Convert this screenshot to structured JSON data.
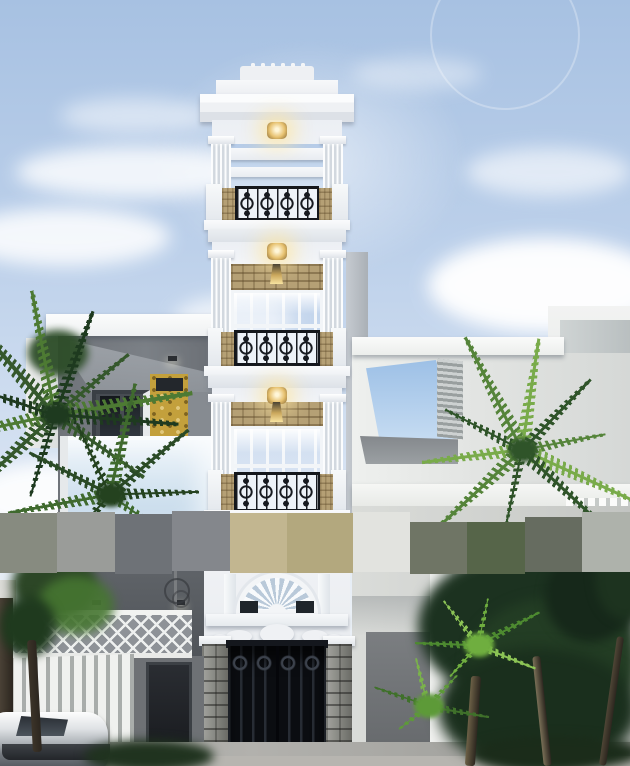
{
  "scene": {
    "type": "architectural-exterior-render",
    "width": 630,
    "height": 766,
    "description": "3D render of a narrow multi-storey neoclassical white townhouse with gold lamps and ornate black wrought-iron balconies, flanked by a dark modern house with glass balcony on the left and white modern volumes on the right, palms and leafy trees at street level, white slat fence, black entry gate on stone-clad columns, a parked car lower-left, blue sky with clouds, and a pixelated censor strip across the middle of the image"
  },
  "palette": {
    "sky_top": "#a7c1e2",
    "sky_mid": "#bcd0ea",
    "sky_low": "#d3e0f1",
    "sky_horizon": "#e9eff6",
    "white_wall": "#f2f3f5",
    "wall_shadow": "#d7dbe1",
    "iron_black": "#14171c",
    "lamp_gold": "#e7c271",
    "lamp_glow": "#fff3c8",
    "stone_tan": "#b5a075",
    "stone_grey": "#85867f",
    "left_house_wall": "#70747a",
    "accent_yellow": "#c3a03c",
    "balcony_glass": "#d9e7f2",
    "right_house_wall": "#e2e4e2",
    "ground_grey": "#a4a4a0",
    "gate_black": "#0b0d11",
    "tree_dark": "#1c3220",
    "tree_mid": "#35582c",
    "tree_bright": "#72a844"
  },
  "censor_band": {
    "default_y": 513,
    "default_h": 60,
    "blocks": [
      {
        "x": 0,
        "w": 57,
        "c": "#878b80"
      },
      {
        "x": 57,
        "w": 58,
        "c": "#9a9c99",
        "y": 512
      },
      {
        "x": 115,
        "w": 57,
        "c": "#6e7277",
        "y": 514
      },
      {
        "x": 172,
        "w": 58,
        "c": "#84878c",
        "y": 511
      },
      {
        "x": 230,
        "w": 57,
        "c": "#c2b690"
      },
      {
        "x": 287,
        "w": 66,
        "c": "#b3a87e"
      },
      {
        "x": 353,
        "w": 57,
        "c": "#e2e3df",
        "y": 512
      },
      {
        "x": 410,
        "w": 57,
        "c": "#6f7565",
        "y": 522,
        "h": 52
      },
      {
        "x": 467,
        "w": 58,
        "c": "#566549",
        "y": 522,
        "h": 52
      },
      {
        "x": 525,
        "w": 57,
        "c": "#666c60",
        "y": 517,
        "h": 55
      },
      {
        "x": 582,
        "w": 48,
        "c": "#aeb2ab",
        "y": 512
      }
    ]
  },
  "lamps": {
    "ceiling": [
      {
        "x": 267,
        "y": 122
      },
      {
        "x": 267,
        "y": 243
      },
      {
        "x": 267,
        "y": 387
      }
    ],
    "sconces": [
      {
        "x": 270,
        "y": 264
      },
      {
        "x": 270,
        "y": 402
      }
    ]
  },
  "trees": {
    "palms": [
      {
        "name": "left-palm-upper",
        "cx": 55,
        "cy": 415,
        "count": 11,
        "len": 118,
        "start": -245,
        "end": 40,
        "colors": [
          "#1e3a1f",
          "#35582c",
          "#4d7a33"
        ]
      },
      {
        "name": "left-palm-lower",
        "cx": 110,
        "cy": 495,
        "count": 8,
        "len": 95,
        "start": -220,
        "end": 30,
        "colors": [
          "#24421f",
          "#3f6a2e",
          "#2a4a26"
        ]
      },
      {
        "name": "right-palm",
        "cx": 522,
        "cy": 450,
        "count": 10,
        "len": 105,
        "start": -250,
        "end": 50,
        "colors": [
          "#2f5429",
          "#55843a",
          "#79ab4a"
        ]
      },
      {
        "name": "ground-fan-1",
        "cx": 478,
        "cy": 645,
        "count": 6,
        "len": 58,
        "start": -220,
        "end": 20,
        "colors": [
          "#6fae3f",
          "#4d8a30",
          "#8cc455"
        ]
      },
      {
        "name": "ground-fan-2",
        "cx": 428,
        "cy": 706,
        "count": 5,
        "len": 52,
        "start": -210,
        "end": 10,
        "colors": [
          "#5d9a38",
          "#3f702a",
          "#7ab34a"
        ]
      }
    ],
    "canopies": [
      {
        "x": 418,
        "y": 552,
        "w": 215,
        "h": 150,
        "c": "#1c3220",
        "blur": 6,
        "o": 1
      },
      {
        "x": 468,
        "y": 598,
        "w": 170,
        "h": 132,
        "c": "#233d24",
        "blur": 6,
        "o": 1
      },
      {
        "x": 545,
        "y": 550,
        "w": 90,
        "h": 92,
        "c": "#16281a",
        "blur": 5,
        "o": 1
      },
      {
        "x": 438,
        "y": 648,
        "w": 200,
        "h": 122,
        "c": "#1a2f1d",
        "blur": 7,
        "o": 1
      },
      {
        "x": 595,
        "y": 536,
        "w": 60,
        "h": 84,
        "c": "#1d331f",
        "blur": 5,
        "o": 1
      },
      {
        "x": 12,
        "y": 552,
        "w": 84,
        "h": 66,
        "c": "#2c4626",
        "blur": 5,
        "o": 1
      },
      {
        "x": 38,
        "y": 576,
        "w": 76,
        "h": 58,
        "c": "#467631",
        "blur": 5,
        "o": 0.9
      },
      {
        "x": 0,
        "y": 596,
        "w": 56,
        "h": 60,
        "c": "#1f3a1e",
        "blur": 5,
        "o": 1
      },
      {
        "x": 84,
        "y": 740,
        "w": 130,
        "h": 32,
        "c": "#20331f",
        "blur": 5,
        "o": 1
      },
      {
        "x": 470,
        "y": 736,
        "w": 170,
        "h": 34,
        "c": "#1b2c1a",
        "blur": 5,
        "o": 1
      },
      {
        "x": 28,
        "y": 330,
        "w": 60,
        "h": 46,
        "c": "#2d4d28",
        "blur": 4,
        "o": 0.95
      }
    ],
    "trunks": [
      {
        "x": 468,
        "y": 676,
        "w": 10,
        "h": 90,
        "c": "#6d6147",
        "rot": 4
      },
      {
        "x": 538,
        "y": 656,
        "w": 8,
        "h": 110,
        "c": "#7a7057",
        "rot": -6
      },
      {
        "x": 608,
        "y": 636,
        "w": 7,
        "h": 130,
        "c": "#4f4636",
        "rot": 8
      },
      {
        "x": 30,
        "y": 640,
        "w": 9,
        "h": 112,
        "c": "#3c3429",
        "rot": -3
      }
    ]
  }
}
